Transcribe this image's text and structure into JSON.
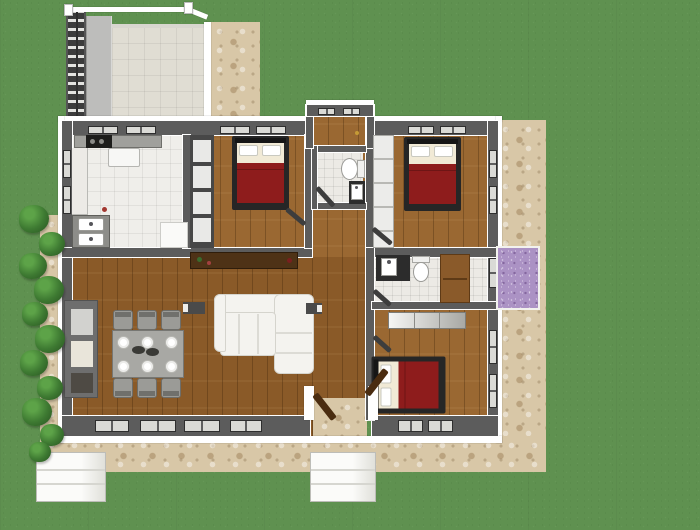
{
  "meta": {
    "title": "Top-down 3D floor plan of a three-bedroom house with lawn, stone paths and rear pergola deck"
  },
  "palette": {
    "grass": "#5f9150",
    "stone": "#d8c7a7",
    "tile": "#e0ddd3",
    "kitchen_tile": "#efeeea",
    "bath_tile": "#eceae5",
    "wood": "#9a6832",
    "wood_living": "#8a5a28",
    "wall": "#5c5c5c",
    "trim": "#ffffff",
    "bed_frame": "#262626",
    "blanket": "#8e1c1c",
    "sheet": "#f1ead6",
    "pillow": "#ffffff",
    "counter": "#a0a09c",
    "counter_dark": "#2c2c2c",
    "cabinet": "#474747",
    "sideboard": "#4e3216",
    "sofa": "#f4f3ef",
    "bush": "#3e7a32",
    "bush_light": "#5da348",
    "flowers": "#ab92c4",
    "planter": "#f6f6f3",
    "vanity": "#8a5a2a",
    "door_wood": "#4a2c10",
    "chair": "#9b9b97",
    "table": "#a8a8a4"
  },
  "rooms": [
    {
      "name": "kitchen",
      "floor": "white tile"
    },
    {
      "name": "bedroom-1",
      "floor": "wood"
    },
    {
      "name": "bathroom-1",
      "floor": "tile"
    },
    {
      "name": "bedroom-2",
      "floor": "wood"
    },
    {
      "name": "living-dining-room",
      "floor": "wood"
    },
    {
      "name": "hallway-vestibule",
      "floor": "wood"
    },
    {
      "name": "bathroom-2",
      "floor": "tile"
    },
    {
      "name": "bedroom-3",
      "floor": "wood"
    },
    {
      "name": "rear-deck-pergola",
      "floor": "paver tile"
    }
  ],
  "furniture_inventory": [
    "3 double beds with dark frames, white pillows and dark-red blankets",
    "L-shaped white sectional sofa",
    "dining table with 6 chairs and 6 white place settings",
    "kitchen L-counter with stove, fridge and double sink",
    "dark sideboard console",
    "2 toilets, 2 washbasins, brown bath vanity",
    "wardrobe and closet units, bedroom dresser",
    "wall shelving / fireplace unit",
    "2 white outdoor planter boxes, purple flower bed, hedge bushes"
  ],
  "windows": [
    [
      88,
      126,
      30,
      8
    ],
    [
      126,
      126,
      30,
      8
    ],
    [
      220,
      126,
      30,
      8
    ],
    [
      256,
      126,
      30,
      8
    ],
    [
      318,
      108,
      17,
      7
    ],
    [
      343,
      108,
      17,
      7
    ],
    [
      408,
      126,
      26,
      8
    ],
    [
      440,
      126,
      26,
      8
    ],
    [
      489,
      150,
      8,
      28
    ],
    [
      489,
      186,
      8,
      28
    ],
    [
      489,
      258,
      8,
      30
    ],
    [
      489,
      330,
      8,
      34
    ],
    [
      489,
      374,
      8,
      34
    ],
    [
      63,
      150,
      8,
      28
    ],
    [
      63,
      186,
      8,
      28
    ],
    [
      95,
      420,
      34,
      12
    ],
    [
      140,
      420,
      36,
      12
    ],
    [
      184,
      420,
      36,
      12
    ],
    [
      230,
      420,
      32,
      12
    ],
    [
      398,
      420,
      25,
      12
    ],
    [
      428,
      420,
      25,
      12
    ]
  ],
  "landscape": {
    "bush_positions": [
      [
        34,
        220,
        30
      ],
      [
        52,
        245,
        26
      ],
      [
        33,
        267,
        28
      ],
      [
        49,
        291,
        30
      ],
      [
        35,
        315,
        26
      ],
      [
        50,
        340,
        30
      ],
      [
        34,
        364,
        28
      ],
      [
        50,
        389,
        26
      ],
      [
        37,
        413,
        30
      ],
      [
        52,
        436,
        24
      ],
      [
        40,
        453,
        22
      ]
    ],
    "planter_count": 2,
    "flower_bed_color": "#ab92c4"
  },
  "dining": {
    "origin": [
      108,
      308
    ],
    "table": [
      4,
      22,
      72,
      48
    ],
    "chairs": [
      [
        5,
        2
      ],
      [
        29,
        2
      ],
      [
        53,
        2
      ],
      [
        5,
        70
      ],
      [
        29,
        70
      ],
      [
        53,
        70
      ]
    ],
    "plates": [
      [
        15,
        34
      ],
      [
        39,
        34
      ],
      [
        63,
        34
      ],
      [
        15,
        58
      ],
      [
        39,
        58
      ],
      [
        63,
        58
      ]
    ],
    "center_dishes": [
      [
        24,
        38
      ],
      [
        38,
        40
      ]
    ]
  }
}
